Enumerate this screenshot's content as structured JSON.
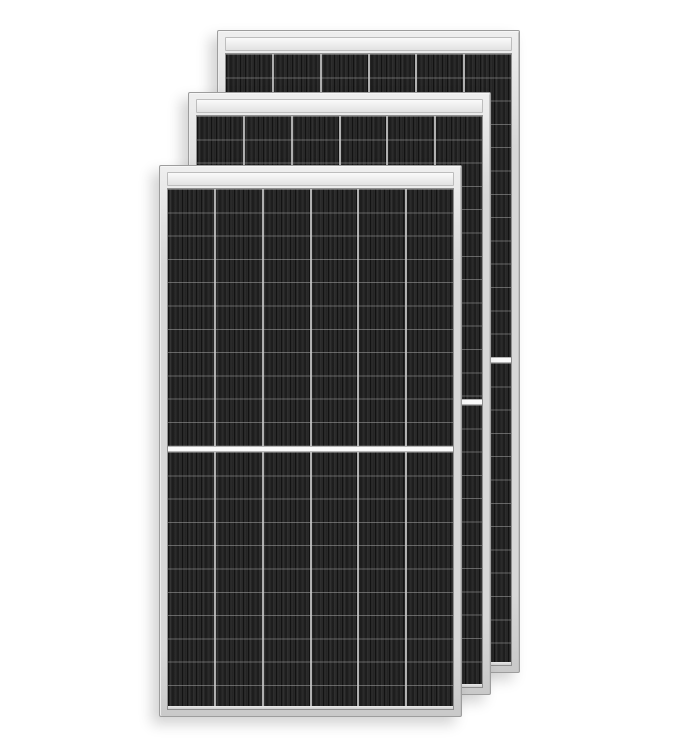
{
  "scene": {
    "subject": "three-stacked-solar-panels",
    "background_color": "#ffffff"
  },
  "colors": {
    "frame": "#d7d7d7",
    "frame_light": "#efefef",
    "frame_border": "#9d9d9d",
    "top_rail": "#e2e2e2",
    "top_rail_light": "#fafafa",
    "top_rail_border": "#bdbdbd",
    "cell_dark": "#232323",
    "stripe_black": "#121212",
    "stripe_light": "#3a3a3a",
    "column_divider": "#c9c9c9",
    "center_band": "#fafafa",
    "center_band_border": "#b5b5b5",
    "bottom_strip": "#cfcfcf"
  },
  "panels": [
    {
      "name": "back",
      "x": 217,
      "y": 30,
      "width": 303,
      "height": 643,
      "columns": 6,
      "cell_rows_per_half": 13
    },
    {
      "name": "middle",
      "x": 188,
      "y": 92,
      "width": 303,
      "height": 603,
      "columns": 6,
      "cell_rows_per_half": 12
    },
    {
      "name": "front",
      "x": 159,
      "y": 165,
      "width": 303,
      "height": 552,
      "columns": 6,
      "cell_rows_per_half": 11
    }
  ]
}
